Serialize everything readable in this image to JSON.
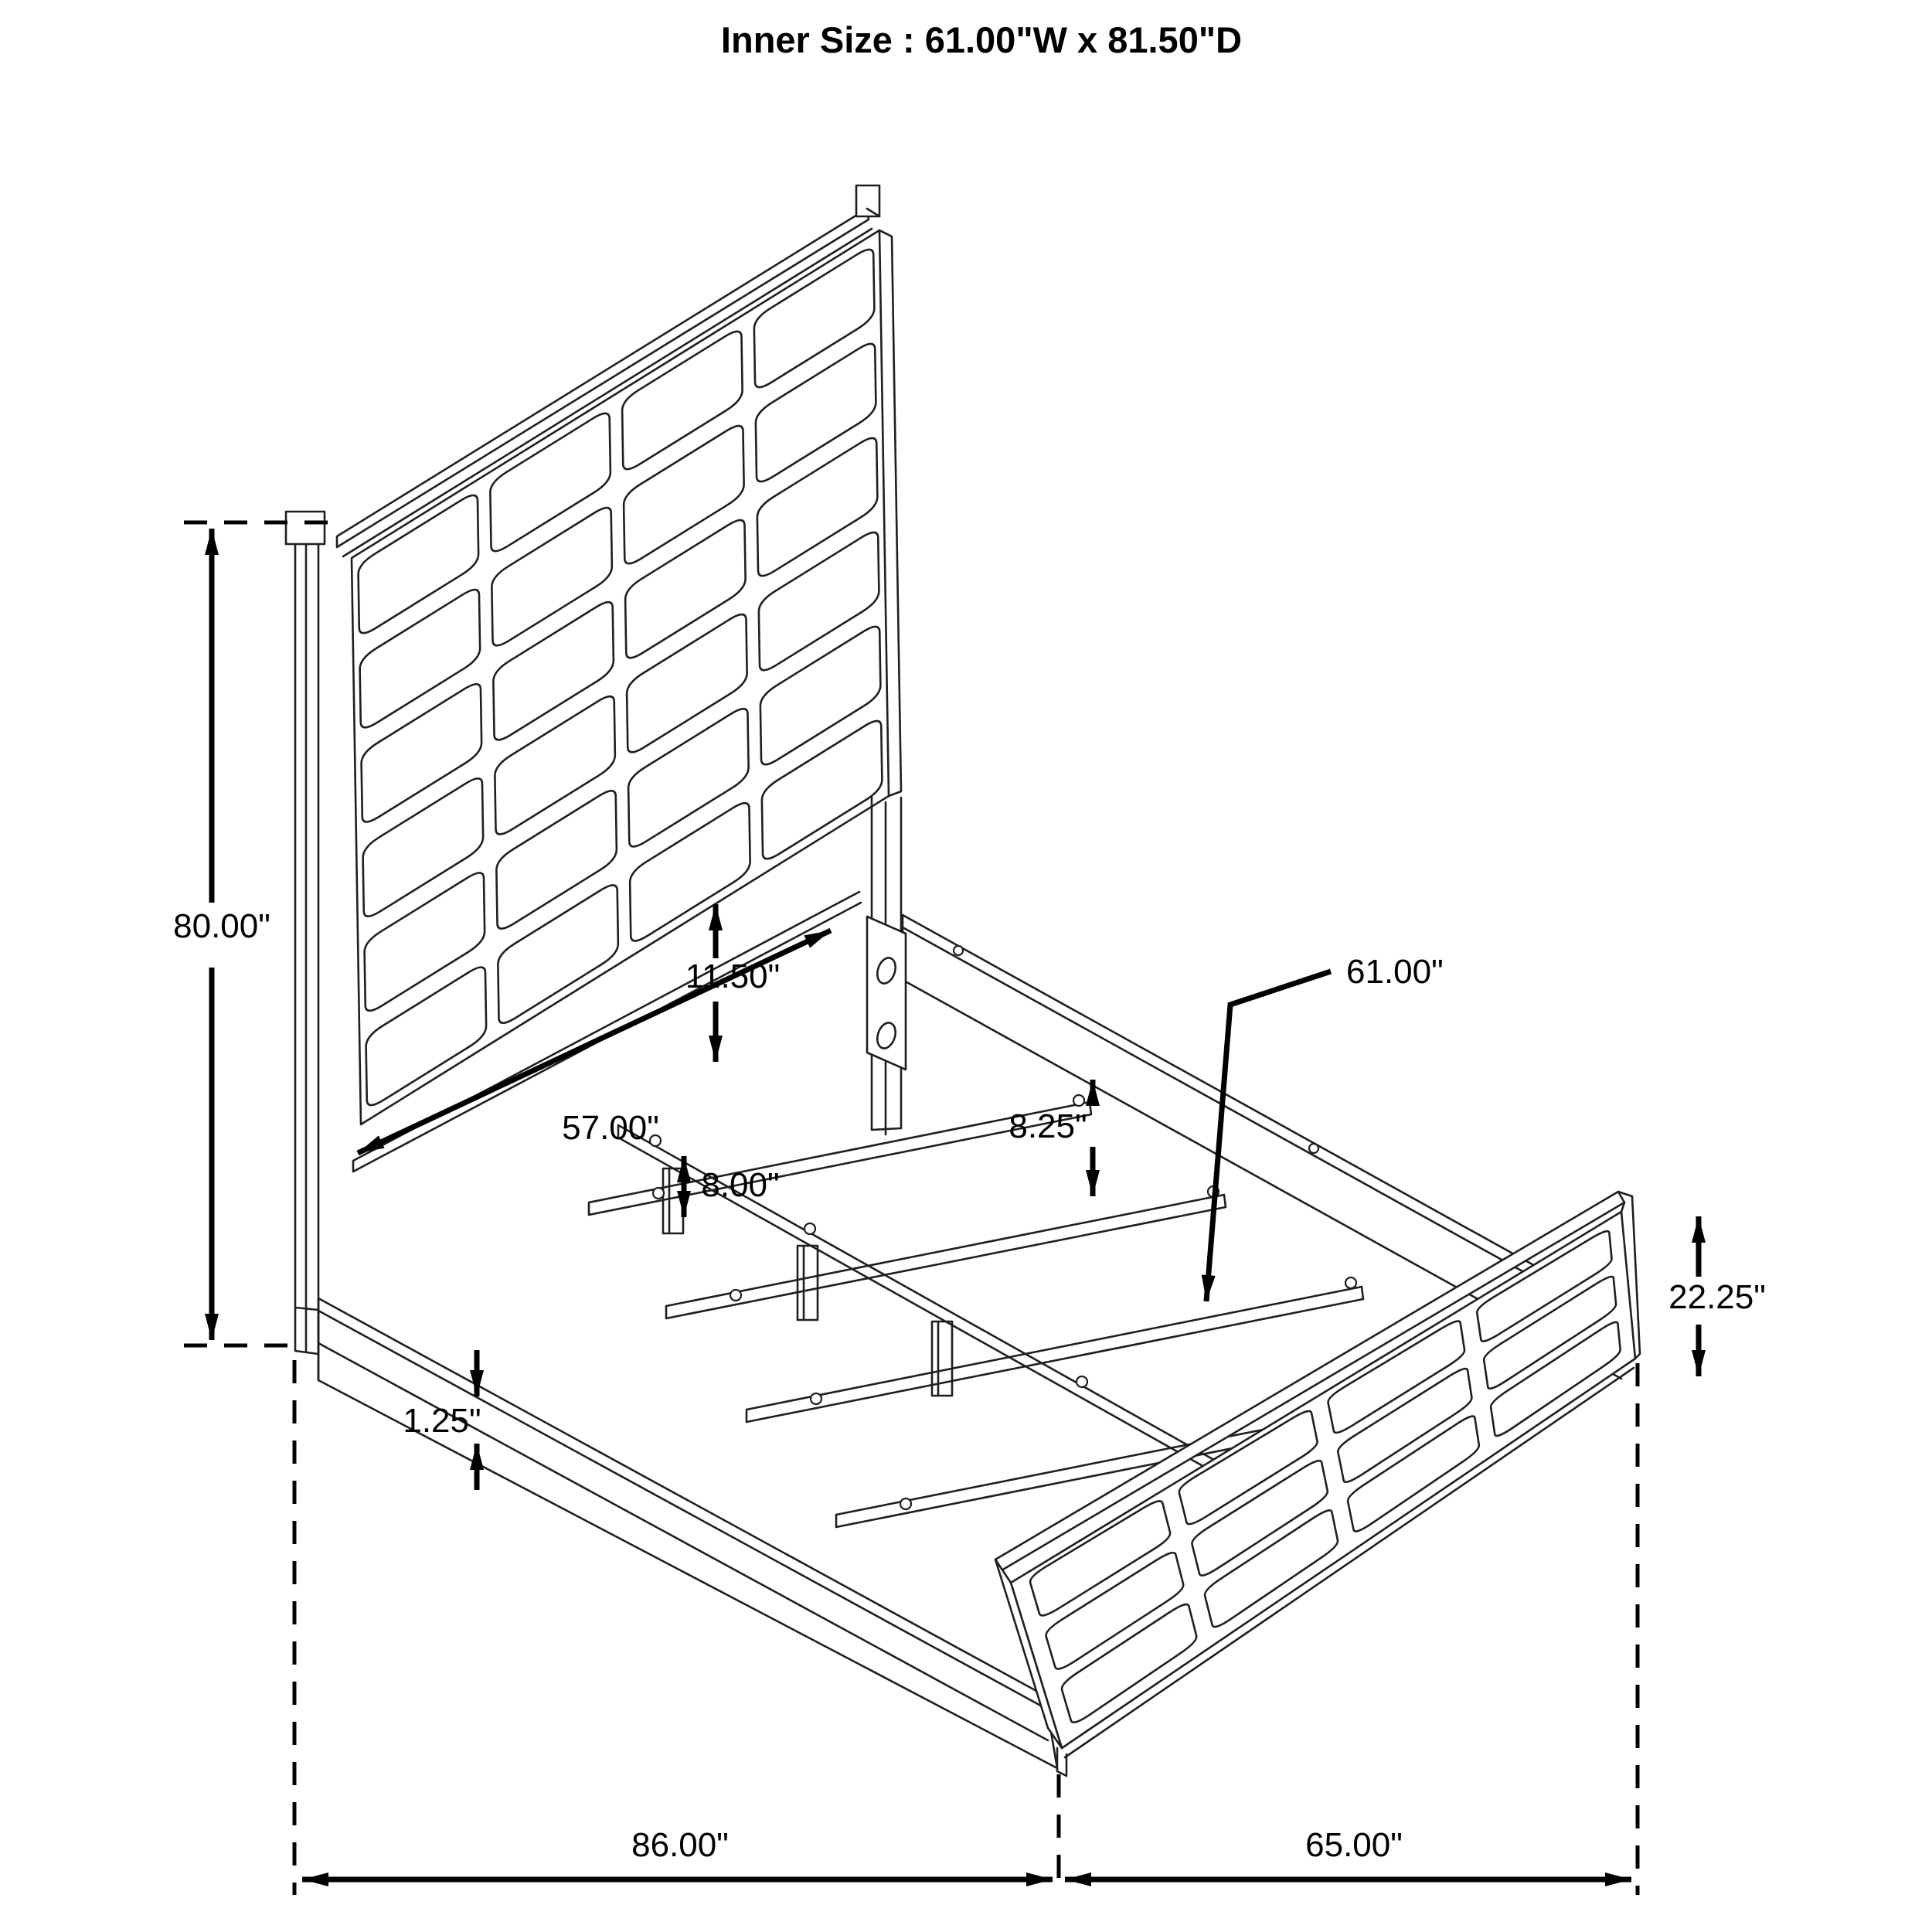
{
  "title": "Inner Size : 61.00\"W x 81.50\"D",
  "diagram": "bed-frame-dimension-drawing",
  "colors": {
    "line": "#1f1f1f",
    "dimension": "#000000",
    "background": "#ffffff"
  },
  "dims": {
    "headboard_height": {
      "label": "80.00\""
    },
    "headboard_gap": {
      "label": "11.50\""
    },
    "inner_head_width": {
      "label": "57.00\""
    },
    "rail_height": {
      "label": "8.25\""
    },
    "slat_length": {
      "label": "61.00\""
    },
    "leg_height": {
      "label": "8.00\""
    },
    "rail_lip": {
      "label": "1.25\""
    },
    "footboard_height": {
      "label": "22.25\""
    },
    "overall_length": {
      "label": "86.00\""
    },
    "overall_width": {
      "label": "65.00\""
    }
  }
}
